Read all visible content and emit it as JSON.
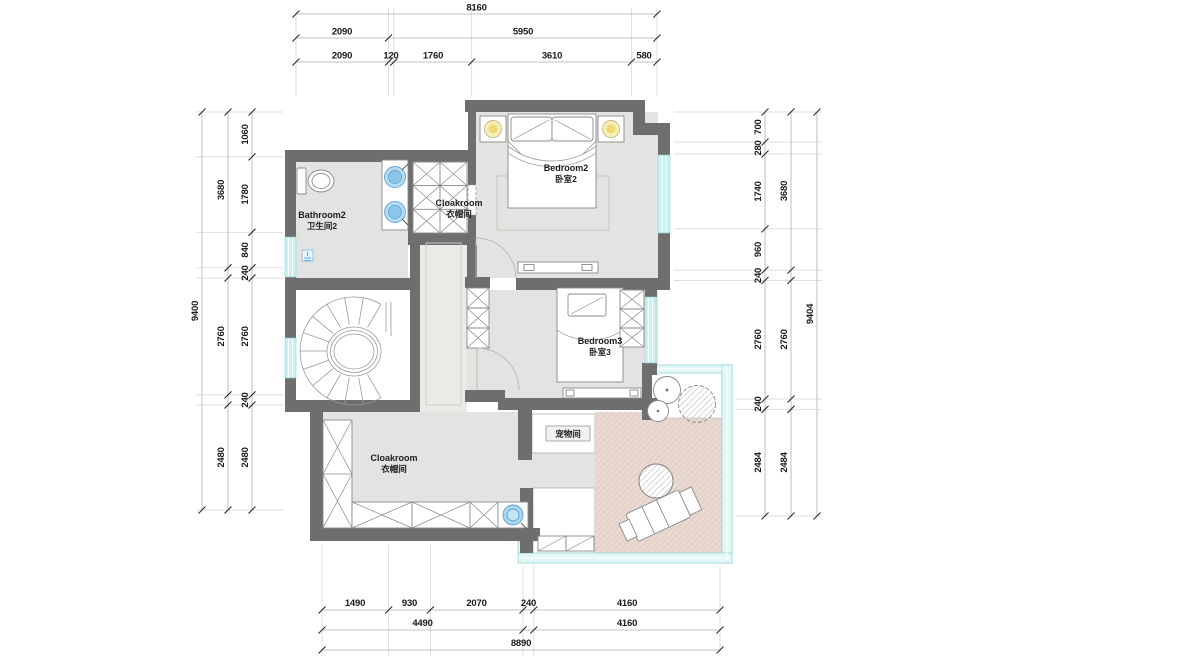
{
  "rooms": {
    "bathroom2": {
      "en": "Bathroom2",
      "zh": "卫生间2"
    },
    "cloakroom_top": {
      "en": "Cloakroom",
      "zh": "衣帽间"
    },
    "bedroom2": {
      "en": "Bedroom2",
      "zh": "卧室2"
    },
    "bedroom3": {
      "en": "Bedroom3",
      "zh": "卧室3"
    },
    "pet_room": {
      "zh": "宠物间"
    },
    "cloakroom_bottom": {
      "en": "Cloakroom",
      "zh": "衣帽间"
    }
  },
  "dims": {
    "top": {
      "total": "8160",
      "row2": [
        "2090",
        "5950"
      ],
      "row3": [
        "2090",
        "120",
        "1760",
        "3610",
        "580"
      ]
    },
    "left": {
      "total": "9400",
      "middle": [
        "3680",
        "2760",
        "2480"
      ],
      "inner": [
        "1060",
        "1780",
        "840",
        "240",
        "2760",
        "240",
        "2480"
      ]
    },
    "right": {
      "total": "9404",
      "middle": [
        "3680",
        "2760",
        "2484"
      ],
      "inner": [
        "700",
        "280",
        "1740",
        "960",
        "240",
        "2760",
        "240",
        "2484"
      ]
    },
    "bottom": {
      "total": "8890",
      "row1": [
        "1490",
        "930",
        "2070",
        "240",
        "4160"
      ],
      "row2": [
        "4490",
        "4160"
      ]
    }
  },
  "colors": {
    "wall": "#6e6e6e",
    "floor": "#e4e3e1",
    "corridor_floor": "#ebeae7",
    "window": "#c9f1f2",
    "terrace_glass": "#e3f7f5",
    "deck": "#e9d9d1",
    "basin": "#8cc6ec",
    "lamp": "#eed973",
    "dimension_text": "#1a1a1a"
  }
}
